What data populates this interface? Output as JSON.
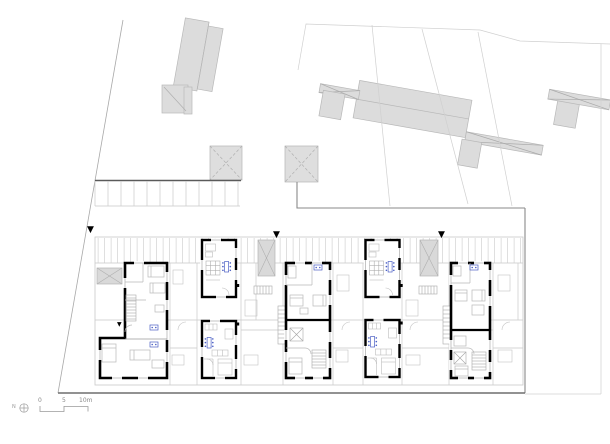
{
  "drawing": {
    "entry_marker_glyph": "▼"
  },
  "scale_bar": {
    "north_label": "N",
    "tick_0": "0",
    "tick_5": "5",
    "tick_10": "10m"
  },
  "colors": {
    "background": "#ffffff",
    "wall_black": "#000000",
    "context_fill": "#dcdcdc",
    "line_light": "#c9c9c9",
    "line_medium": "#9a9a9a",
    "line_dark": "#6f6f6f",
    "fixture_blue": "#4a5fc4"
  }
}
